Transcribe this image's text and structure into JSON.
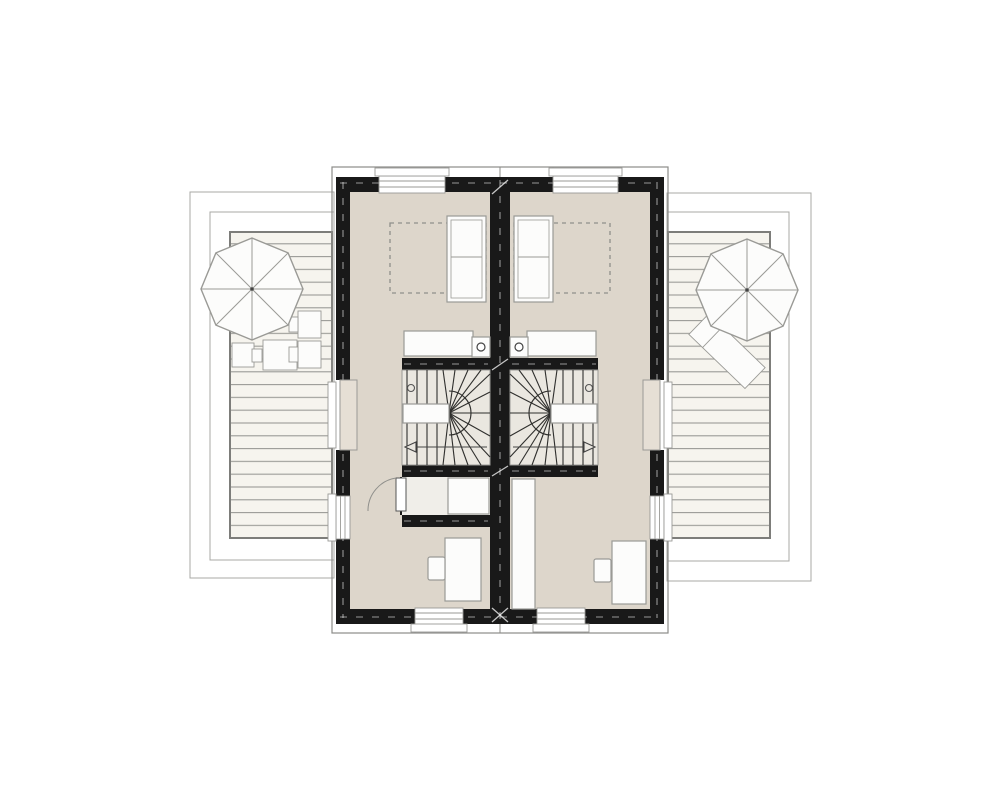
{
  "document": {
    "type": "architectural-floor-plan",
    "description": "Upper floor plan of a semi-detached house: two mirrored dwelling units separated by a central party wall, each with a bedroom, winder staircase, desk workspace, and a flanking roof terrace with wooden decking and a parasol",
    "visible_text": []
  },
  "colors": {
    "bg": "#ffffff",
    "wall": "#191919",
    "floor": "#ddd6cb",
    "stair": "#eae7e0",
    "closet": "#f0eee9",
    "deckFill": "#f6f4ee",
    "deckLine": "#9a9a96",
    "deckBorder": "#7d7d7a",
    "outline": "#a8a8a5",
    "roof": "#8c8c89",
    "furnFill": "#fcfcfb",
    "furnStroke": "#9a9a96",
    "rugDash": "#8f8f8b",
    "reveal": "#e6dfd5",
    "lineDark": "#2f2f2d"
  },
  "units": [
    {
      "name": "left-unit",
      "rooms": [
        "bedroom",
        "stair-hall"
      ],
      "items": [
        "double-bed",
        "rug-outline",
        "sideboard",
        "pedestal-with-lamp",
        "winder-staircase",
        "stair-direction-arrow",
        "closet",
        "hinged-door",
        "desk",
        "desk-chair"
      ],
      "windows": [
        "north-window",
        "south-window",
        "west-terrace-door",
        "west-window"
      ]
    },
    {
      "name": "right-unit",
      "rooms": [
        "bedroom",
        "stair-hall"
      ],
      "items": [
        "double-bed",
        "rug-outline",
        "sideboard",
        "pedestal-with-lamp",
        "winder-staircase",
        "stair-direction-arrow",
        "tall-wardrobe",
        "desk",
        "desk-chair"
      ],
      "windows": [
        "north-window",
        "south-window",
        "east-terrace-door",
        "east-window"
      ]
    }
  ],
  "terraces": [
    {
      "name": "left-terrace",
      "items": [
        "deck-boards",
        "parasol",
        "deck-chair",
        "deck-chair",
        "deck-chair",
        "side-table"
      ]
    },
    {
      "name": "right-terrace",
      "items": [
        "deck-boards",
        "parasol",
        "sun-lounger"
      ]
    }
  ],
  "stairs": {
    "type": "winder",
    "straight_treads_per_stair": 4,
    "landing": "central-handrail-island",
    "direction_arrows": "pointing-outward"
  }
}
